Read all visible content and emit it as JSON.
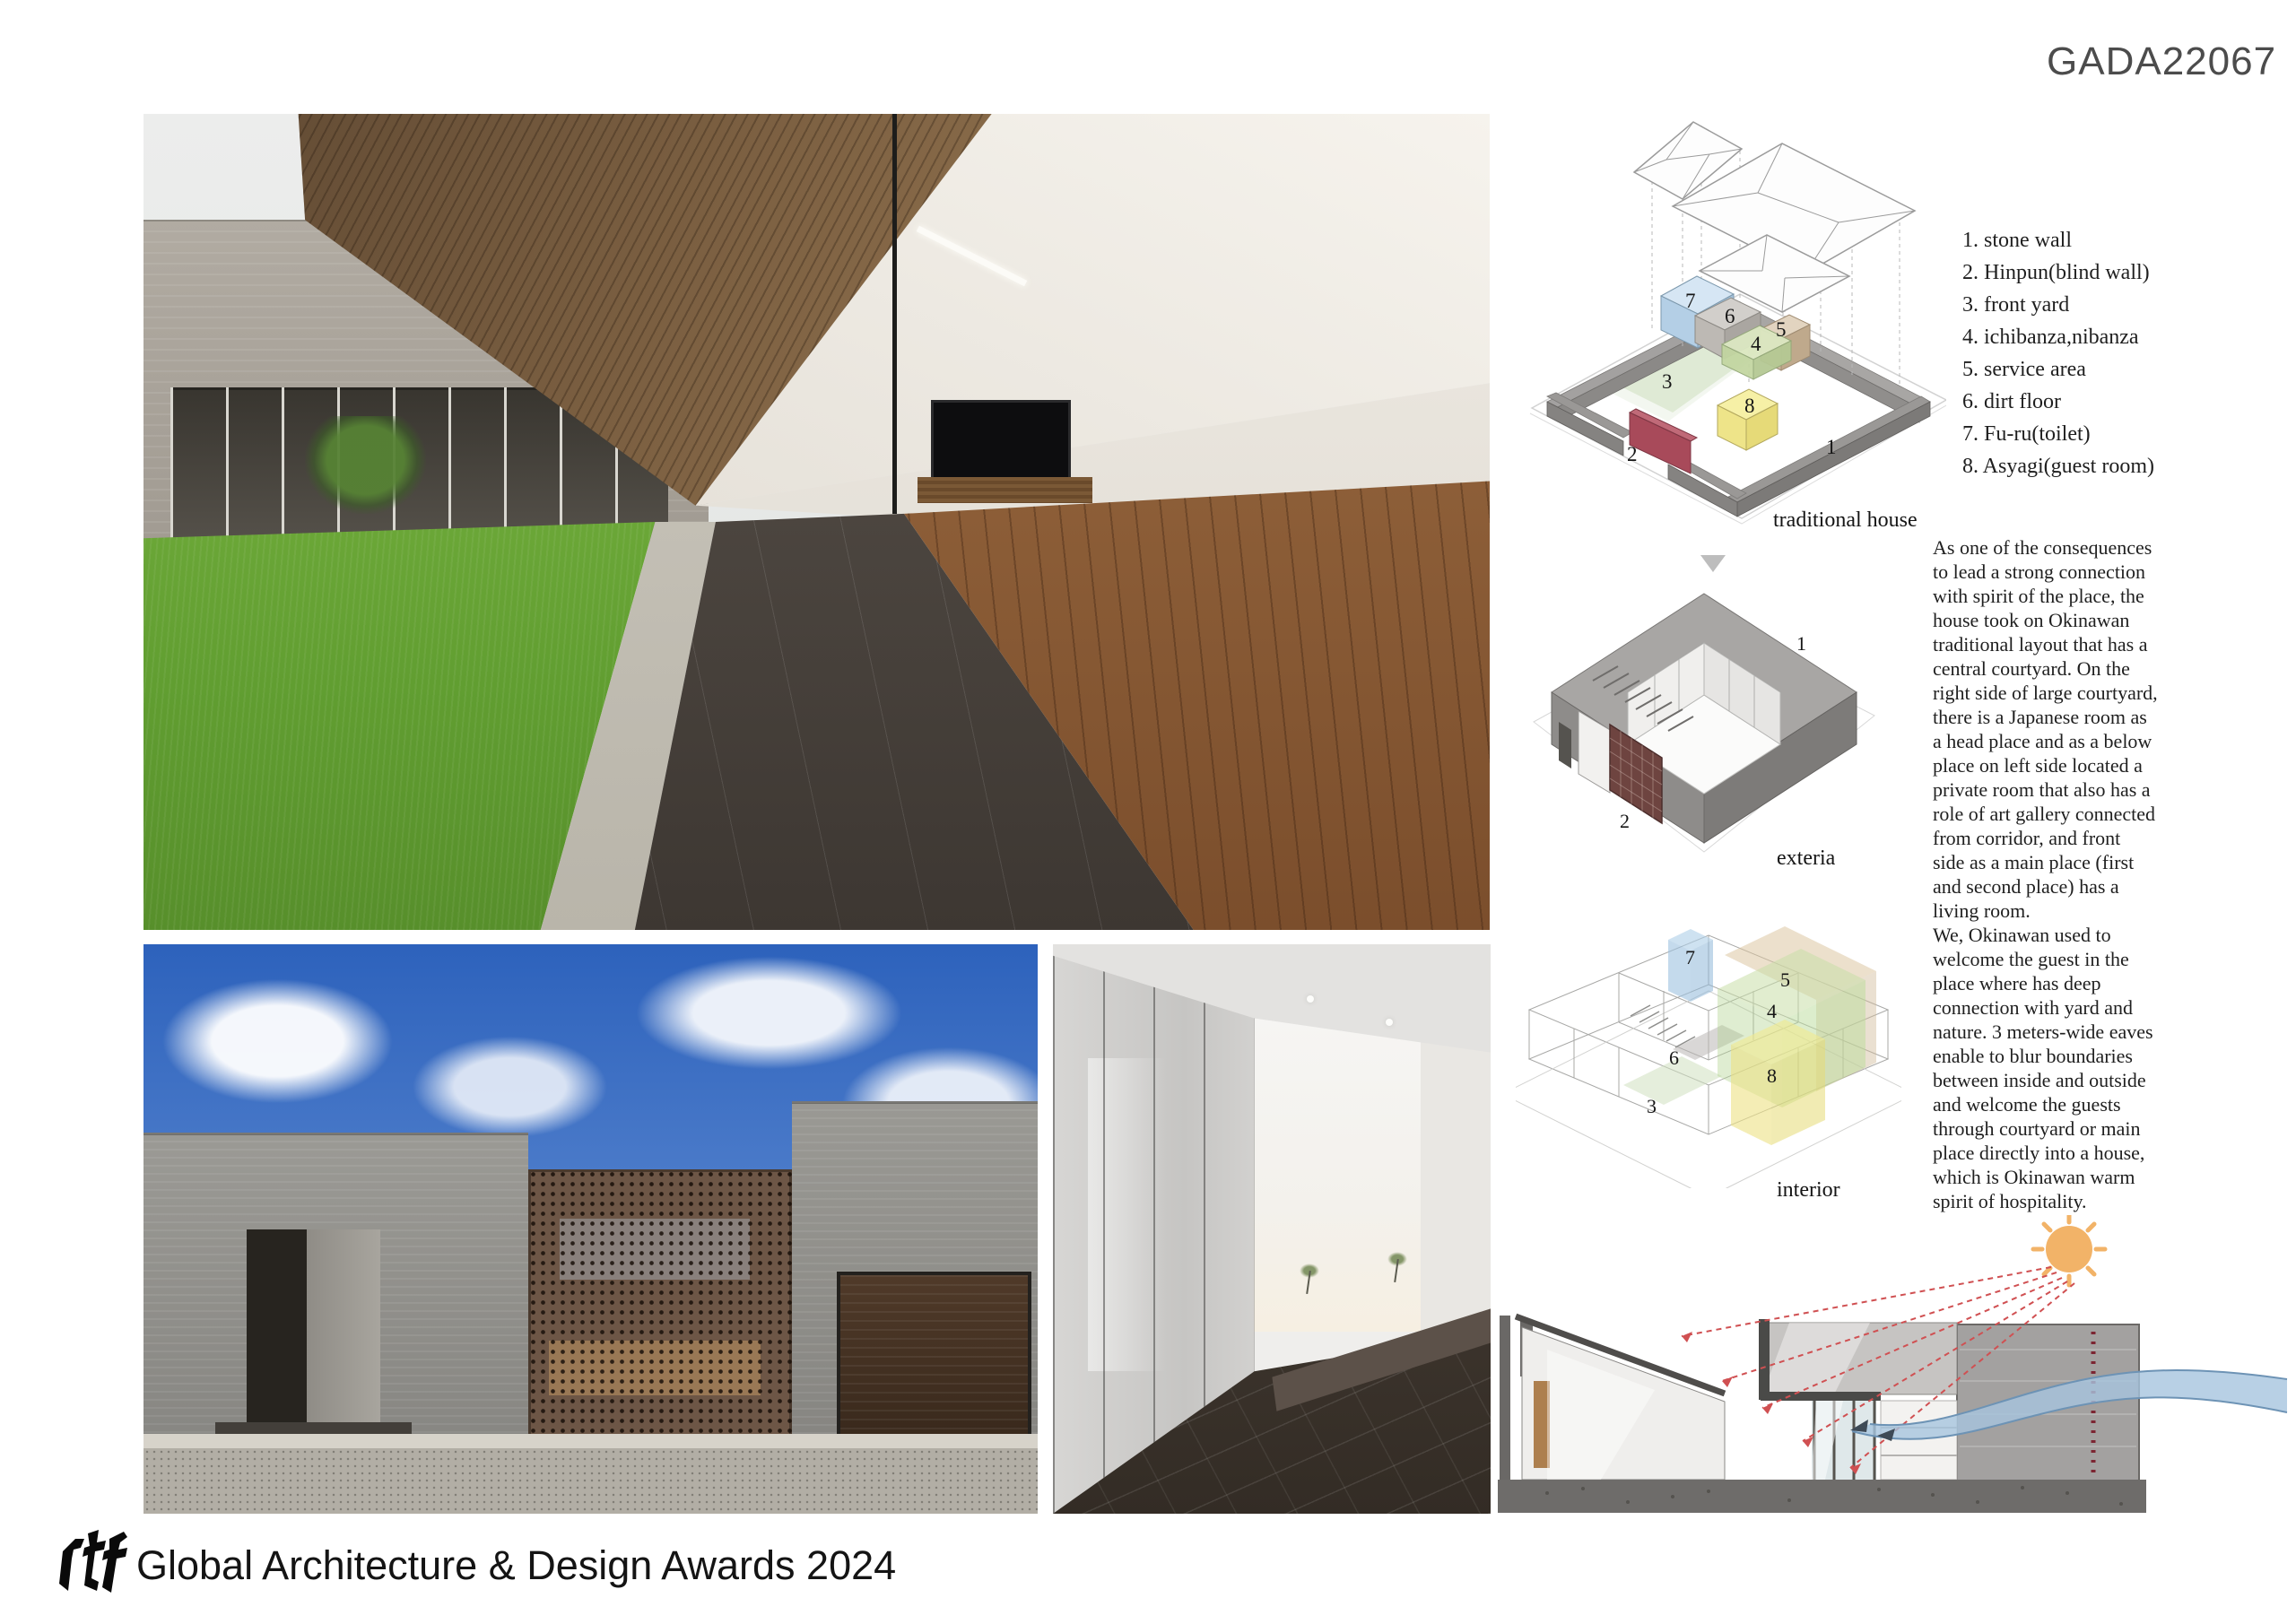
{
  "header": {
    "code": "GADA22067"
  },
  "legend": {
    "items": [
      "1. stone wall",
      "2. Hinpun(blind wall)",
      "3. front yard",
      "4. ichibanza,nibanza",
      "5. service area",
      "6. dirt floor",
      "7. Fu-ru(toilet)",
      "8. Asyagi(guest room)"
    ]
  },
  "description": "As one of the consequences\nto lead a strong connection\nwith spirit of the place, the\nhouse took on Okinawan\ntraditional layout that has a\ncentral courtyard. On the\nright side of large courtyard,\nthere is a Japanese room as\na head place and as a below\nplace on left side located a\nprivate room that also has a\nrole of art gallery connected\nfrom corridor, and front\nside as a main place (first\nand second place) has a\nliving room.\nWe, Okinawan used to\nwelcome the guest in the\nplace where has deep\nconnection with yard and\nnature. 3 meters-wide eaves\nenable to blur boundaries\nbetween inside and outside\nand welcome the guests\nthrough courtyard or main\nplace directly into a house,\nwhich is Okinawan warm\nspirit of hospitality.",
  "diagrams": {
    "traditional": {
      "caption": "traditional house",
      "labels": {
        "n1": "1",
        "n2": "2",
        "n3": "3",
        "n4": "4",
        "n5": "5",
        "n6": "6",
        "n7": "7",
        "n8": "8"
      }
    },
    "exteria": {
      "caption": "exteria",
      "labels": {
        "n1": "1",
        "n2": "2"
      }
    },
    "interior": {
      "caption": "interior",
      "labels": {
        "n3": "3",
        "n4": "4",
        "n5": "5",
        "n6": "6",
        "n7": "7",
        "n8": "8"
      }
    }
  },
  "footer": {
    "logo": "rtf",
    "title": "Global Architecture & Design Awards 2024"
  },
  "colors": {
    "room_blue": "#b8d4ec",
    "room_gray": "#c9c6c2",
    "room_tan": "#ddcdb6",
    "room_green": "#d3e2b4",
    "room_yellow": "#f4eda0",
    "hinpun_red": "#a84a5a",
    "stone_gray": "#8c8a87",
    "sun_orange": "#f2b368",
    "breeze_blue": "#a6c4de",
    "ray_red": "#d05052",
    "brick_brown": "#6d5646",
    "sky_blue": "#2d62bc",
    "lawn_green": "#6fae3a"
  }
}
